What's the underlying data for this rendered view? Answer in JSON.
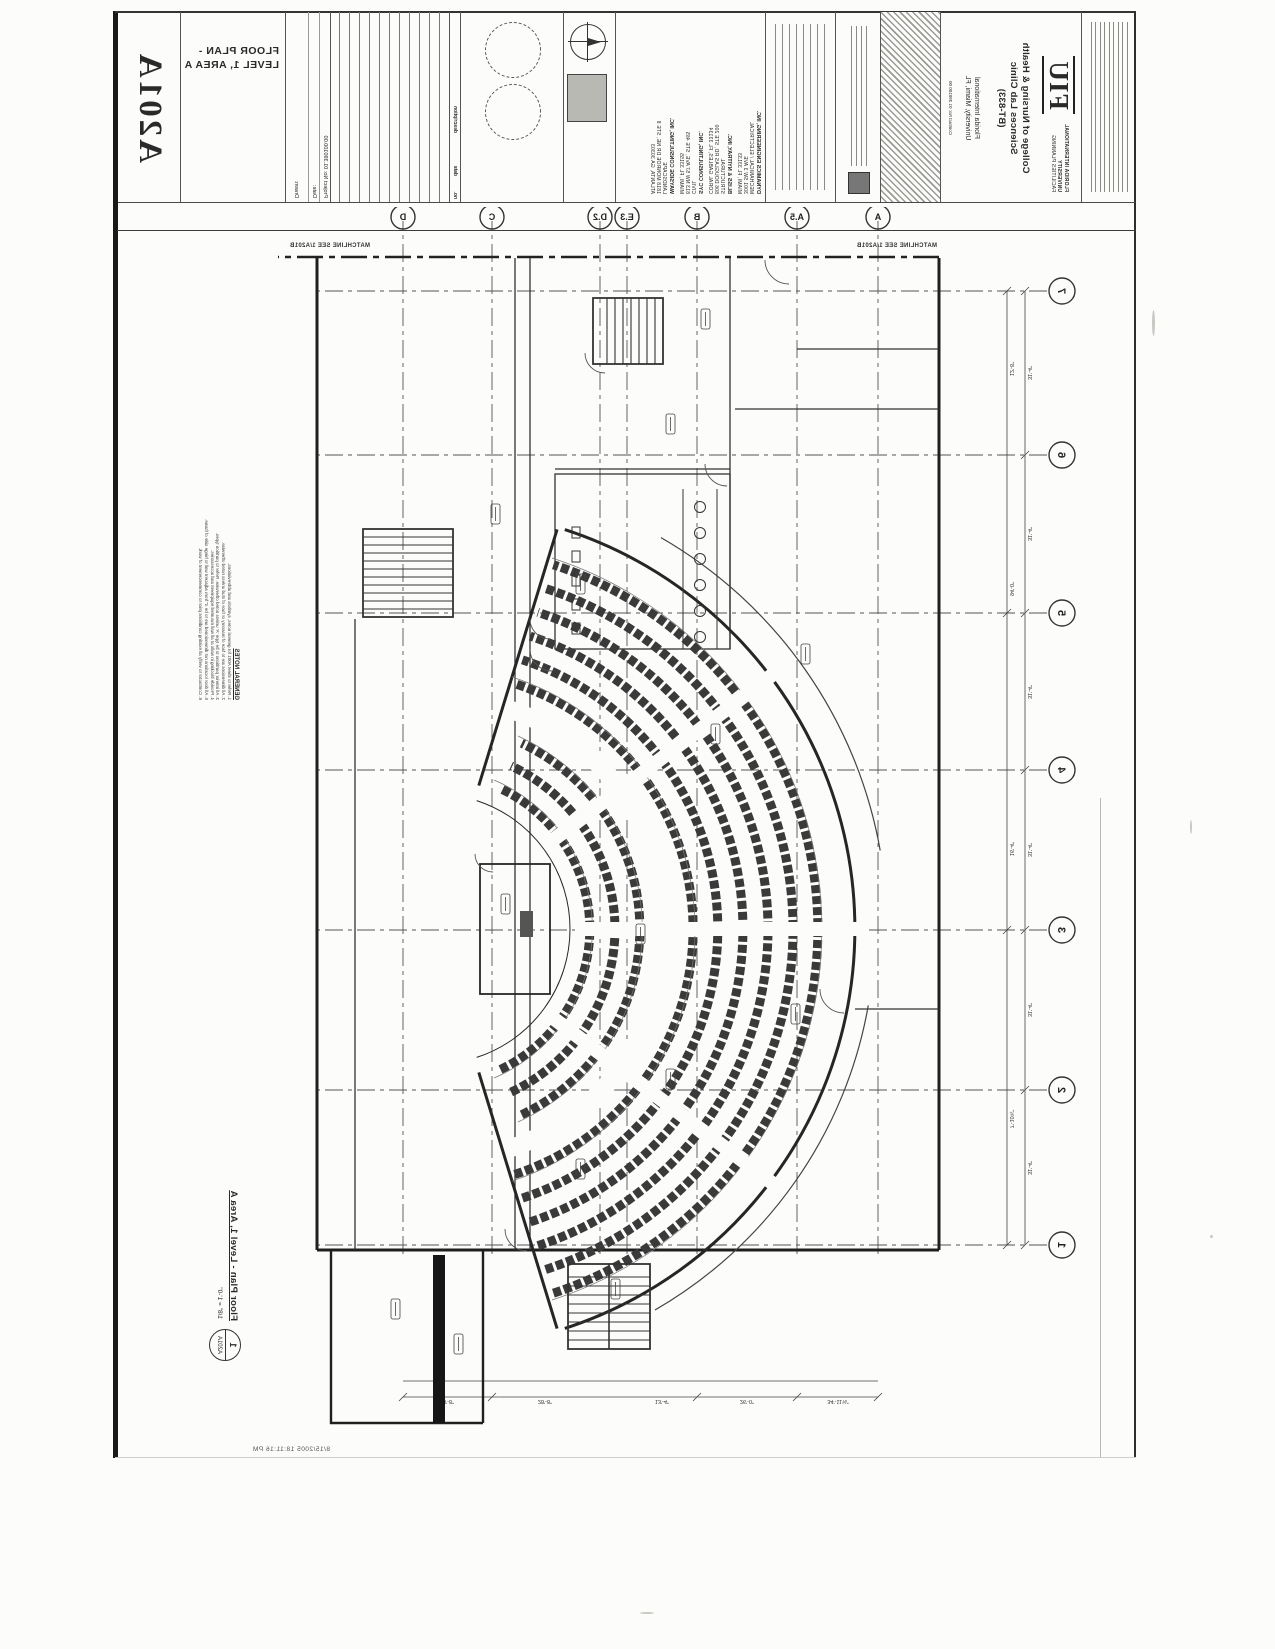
{
  "sheet": {
    "number": "A201A",
    "title_line1": "FLOOR PLAN -",
    "title_line2": "LEVEL 1, AREA A",
    "drawing_title": "Floor Plan - Level 1, Area A",
    "drawing_scale": "1/8\" = 1'-0\"",
    "detail_number": "1",
    "detail_sheet": "A201A",
    "plot_stamp": "8/15/2005 18:11:16 PM"
  },
  "project": {
    "logo": "FIU",
    "university_line1": "FLORIDA INTERNATIONAL",
    "university_line2": "UNIVERSITY",
    "university_line3": "FACILITIES PLANNING",
    "name_line1": "College of Nursing & Health",
    "name_line2": "Sciences Lab Clinic",
    "name_line3": "(BT-833)",
    "location_line1": "Florida International",
    "location_line2": "University, Miami, FL",
    "contract": "Contract No: 01 390100 00"
  },
  "grid": {
    "columns": [
      "1",
      "2",
      "3",
      "4",
      "5",
      "6",
      "7"
    ],
    "rows": [
      "A",
      "A.5",
      "B",
      "E.3",
      "D.2",
      "C",
      "D"
    ]
  },
  "matchline": {
    "label": "MATCHLINE  SEE 1/A201B"
  },
  "titleblock": {
    "revisions": {
      "no": "no.",
      "date": "date",
      "desc": "description"
    },
    "fields": [
      {
        "label": "Project No:",
        "value": "01.390100.00"
      },
      {
        "label": "Date:",
        "value": ""
      },
      {
        "label": "Drawn:",
        "value": ""
      },
      {
        "label": "Checked:",
        "value": ""
      }
    ],
    "consultants": [
      {
        "firm": "DYNAMICS ENGINEERING, INC.",
        "discipline": "MECHANICAL / ELECTRICAL",
        "address": "3001 SW 3 AVE",
        "city": "MIAMI, FL 33133"
      },
      {
        "firm": "BLISS & NYITRAY, INC.",
        "discipline": "STRUCTURAL",
        "address": "806 DOUGLAS RD, STE 200",
        "city": "CORAL GABLES, FL 33134"
      },
      {
        "firm": "SYC CONSULTING, INC.",
        "discipline": "CIVIL",
        "address": "813 NW 57 AVE, STE 465",
        "city": "MIAMI, FL 33155"
      },
      {
        "firm": "WAYSIDE CONSULTING, INC.",
        "discipline": "LANDSCAPE",
        "address": "1818 MONROE DR NE, STE 8",
        "city": "ATLANTA, GA 30303"
      }
    ]
  },
  "notes": {
    "heading": "GENERAL NOTES",
    "lines": [
      "1.  Refer to sheet A001 for general notes, symbols and abbreviations.",
      "2.  All dimensions are to face of masonry or face of stud unless noted otherwise.",
      "3.  All interior partitions to be type 'A' unless noted otherwise. Refer to partition types.",
      "4.  Provide blocking in walls at all wall mounted equipment and accessories.",
      "5.  All door locations not dimensioned are to be 4\" from adjacent wall to hinge side of frame.",
      "6.  Contractor to verify all existing conditions prior to commencement of work."
    ]
  },
  "dims": {
    "top_row1": [
      "31'-4\"",
      "31'-4\"",
      "31'-4\"",
      "31'-4\"",
      "31'-4\"",
      "31'-4\""
    ],
    "top_row2": [
      "7'-10¾\"",
      "16'-4\"",
      "94'-0\"",
      "12'-8\""
    ],
    "left": [
      "34'-11⅝\"",
      "26'-0\"",
      "13'-4\"",
      "28'-8\"",
      "18'-8\""
    ]
  }
}
